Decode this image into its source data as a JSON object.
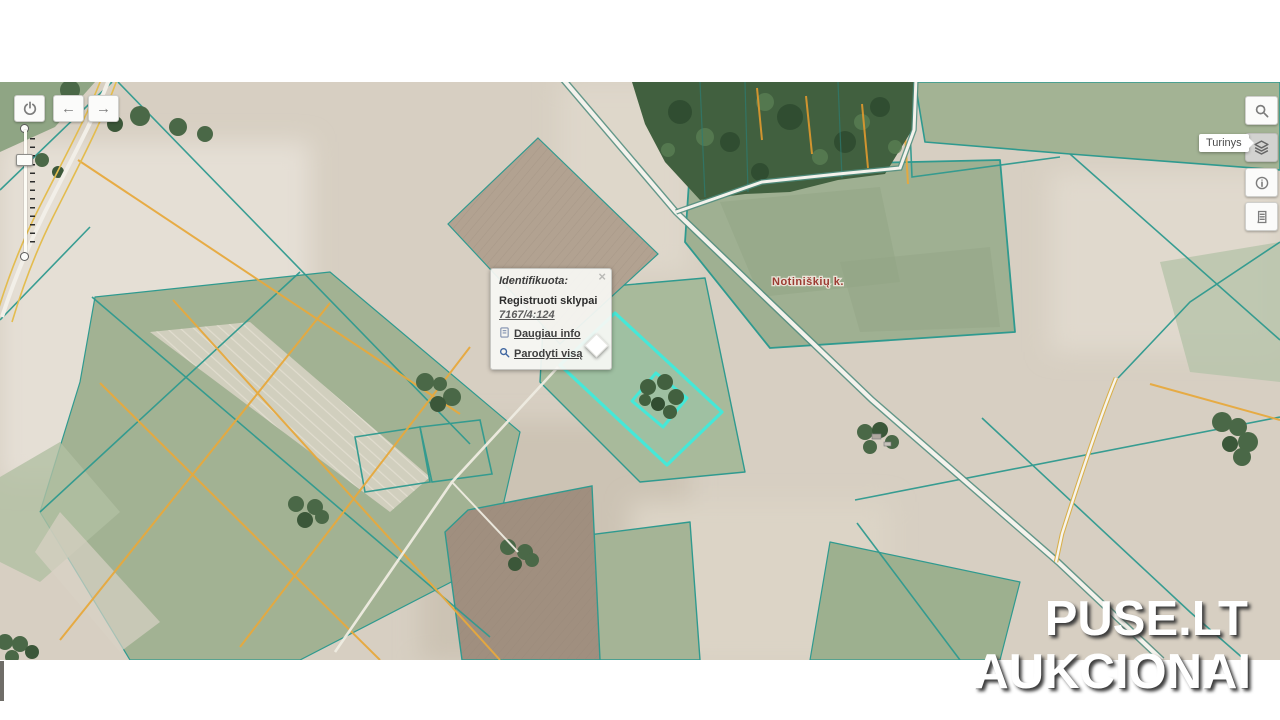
{
  "map": {
    "village_label": "Notiniškių k."
  },
  "tooltip": {
    "label": "Turinys"
  },
  "popup": {
    "title": "Identifikuota:",
    "close_glyph": "×",
    "section_title": "Registruoti sklypai",
    "parcel_code": "7167/4:124",
    "more_info_label": "Daugiau info",
    "show_all_label": "Parodyti visą"
  },
  "watermark": {
    "line1": "PUSE.LT",
    "line2": "AUKCIONAI"
  },
  "icons": {
    "back_arrow": "←",
    "forward_arrow": "→",
    "power": "power-icon",
    "search": "search-icon",
    "layers": "layers-icon",
    "info": "info-icon",
    "legend": "legend-icon"
  },
  "colors": {
    "boundary_teal": "#2f9a8f",
    "boundary_orange": "#e7a93d",
    "highlight_cyan": "#45e8d8",
    "village_label_red": "#9c3a31",
    "road_casing": "#4f8d7f"
  }
}
